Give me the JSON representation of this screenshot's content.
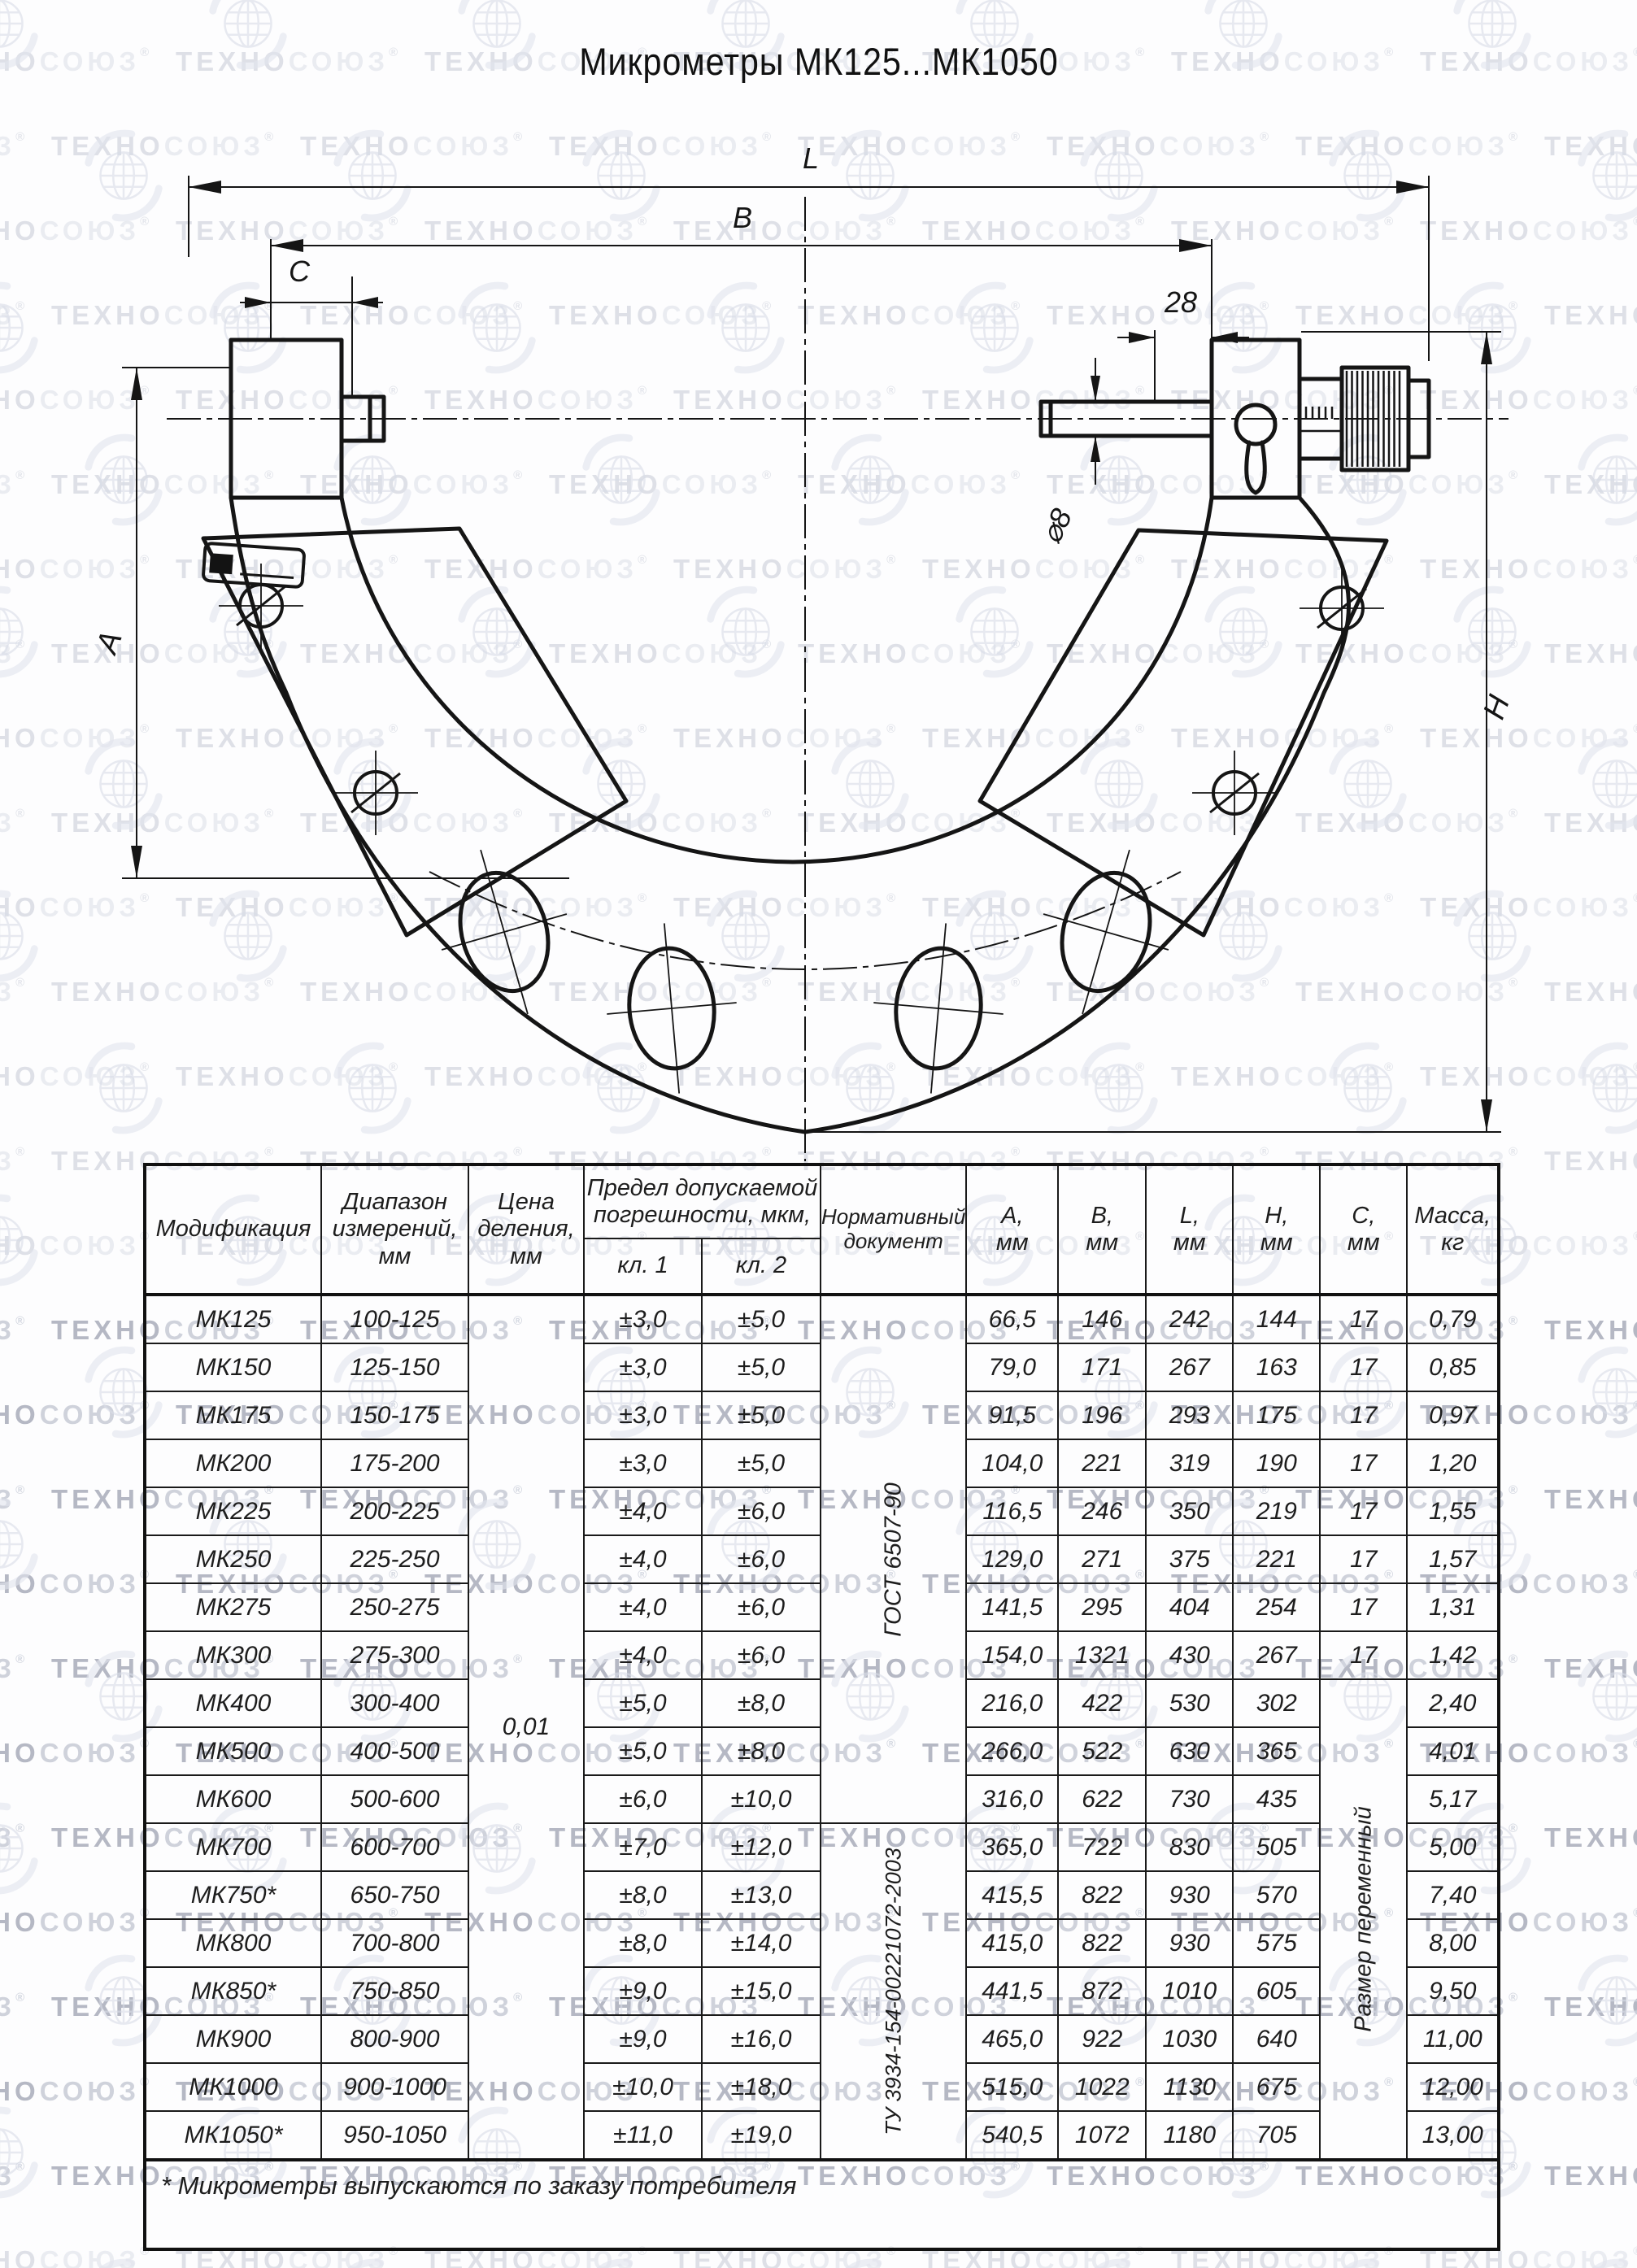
{
  "title": "Микрометры МК125...МК1050",
  "watermark": {
    "brand_part1": "ТЕХНО",
    "brand_part2": "СОЮЗ",
    "registered": "®"
  },
  "drawing": {
    "labels": {
      "L": "L",
      "B": "B",
      "C": "C",
      "dim28": "28",
      "dia8": "⌀8",
      "A": "A",
      "H": "H"
    }
  },
  "table": {
    "headers": {
      "modification": "Модификация",
      "range": "Диапазон\nизмерений,\nмм",
      "division": "Цена\nделения,\nмм",
      "error_limit": "Предел допускаемой\nпогрешности, мкм,",
      "class1": "кл. 1",
      "class2": "кл. 2",
      "normative": "Нормативный\nдокумент",
      "a": "А,\nмм",
      "b": "В,\nмм",
      "l": "L,\nмм",
      "h": "Н,\nмм",
      "c": "С,\nмм",
      "mass": "Масса,\nкг"
    },
    "merged": {
      "division_value": "0,01",
      "gost": "ГОСТ 6507-90",
      "tu": "ТУ 3934-154-00221072-2003",
      "variable_size": "Размер переменный"
    },
    "rows": [
      {
        "mod": "МК125",
        "range": "100-125",
        "kl1": "±3,0",
        "kl2": "±5,0",
        "a": "66,5",
        "b": "146",
        "l": "242",
        "h": "144",
        "c": "17",
        "mass": "0,79"
      },
      {
        "mod": "МК150",
        "range": "125-150",
        "kl1": "±3,0",
        "kl2": "±5,0",
        "a": "79,0",
        "b": "171",
        "l": "267",
        "h": "163",
        "c": "17",
        "mass": "0,85"
      },
      {
        "mod": "МК175",
        "range": "150-175",
        "kl1": "±3,0",
        "kl2": "±5,0",
        "a": "91,5",
        "b": "196",
        "l": "293",
        "h": "175",
        "c": "17",
        "mass": "0,97"
      },
      {
        "mod": "МК200",
        "range": "175-200",
        "kl1": "±3,0",
        "kl2": "±5,0",
        "a": "104,0",
        "b": "221",
        "l": "319",
        "h": "190",
        "c": "17",
        "mass": "1,20"
      },
      {
        "mod": "МК225",
        "range": "200-225",
        "kl1": "±4,0",
        "kl2": "±6,0",
        "a": "116,5",
        "b": "246",
        "l": "350",
        "h": "219",
        "c": "17",
        "mass": "1,55"
      },
      {
        "mod": "МК250",
        "range": "225-250",
        "kl1": "±4,0",
        "kl2": "±6,0",
        "a": "129,0",
        "b": "271",
        "l": "375",
        "h": "221",
        "c": "17",
        "mass": "1,57"
      },
      {
        "mod": "МК275",
        "range": "250-275",
        "kl1": "±4,0",
        "kl2": "±6,0",
        "a": "141,5",
        "b": "295",
        "l": "404",
        "h": "254",
        "c": "17",
        "mass": "1,31"
      },
      {
        "mod": "МК300",
        "range": "275-300",
        "kl1": "±4,0",
        "kl2": "±6,0",
        "a": "154,0",
        "b": "1321",
        "l": "430",
        "h": "267",
        "c": "17",
        "mass": "1,42"
      },
      {
        "mod": "МК400",
        "range": "300-400",
        "kl1": "±5,0",
        "kl2": "±8,0",
        "a": "216,0",
        "b": "422",
        "l": "530",
        "h": "302",
        "c": null,
        "mass": "2,40"
      },
      {
        "mod": "МК500",
        "range": "400-500",
        "kl1": "±5,0",
        "kl2": "±8,0",
        "a": "266,0",
        "b": "522",
        "l": "630",
        "h": "365",
        "c": null,
        "mass": "4,01"
      },
      {
        "mod": "МК600",
        "range": "500-600",
        "kl1": "±6,0",
        "kl2": "±10,0",
        "a": "316,0",
        "b": "622",
        "l": "730",
        "h": "435",
        "c": null,
        "mass": "5,17"
      },
      {
        "mod": "МК700",
        "range": "600-700",
        "kl1": "±7,0",
        "kl2": "±12,0",
        "a": "365,0",
        "b": "722",
        "l": "830",
        "h": "505",
        "c": null,
        "mass": "5,00"
      },
      {
        "mod": "МК750*",
        "range": "650-750",
        "kl1": "±8,0",
        "kl2": "±13,0",
        "a": "415,5",
        "b": "822",
        "l": "930",
        "h": "570",
        "c": null,
        "mass": "7,40"
      },
      {
        "mod": "МК800",
        "range": "700-800",
        "kl1": "±8,0",
        "kl2": "±14,0",
        "a": "415,0",
        "b": "822",
        "l": "930",
        "h": "575",
        "c": null,
        "mass": "8,00"
      },
      {
        "mod": "МК850*",
        "range": "750-850",
        "kl1": "±9,0",
        "kl2": "±15,0",
        "a": "441,5",
        "b": "872",
        "l": "1010",
        "h": "605",
        "c": null,
        "mass": "9,50"
      },
      {
        "mod": "МК900",
        "range": "800-900",
        "kl1": "±9,0",
        "kl2": "±16,0",
        "a": "465,0",
        "b": "922",
        "l": "1030",
        "h": "640",
        "c": null,
        "mass": "11,00"
      },
      {
        "mod": "МК1000",
        "range": "900-1000",
        "kl1": "±10,0",
        "kl2": "±18,0",
        "a": "515,0",
        "b": "1022",
        "l": "1130",
        "h": "675",
        "c": null,
        "mass": "12,00"
      },
      {
        "mod": "МК1050*",
        "range": "950-1050",
        "kl1": "±11,0",
        "kl2": "±19,0",
        "a": "540,5",
        "b": "1072",
        "l": "1180",
        "h": "705",
        "c": null,
        "mass": "13,00"
      }
    ],
    "footnote": "* Микрометры выпускаются по заказу потребителя"
  }
}
